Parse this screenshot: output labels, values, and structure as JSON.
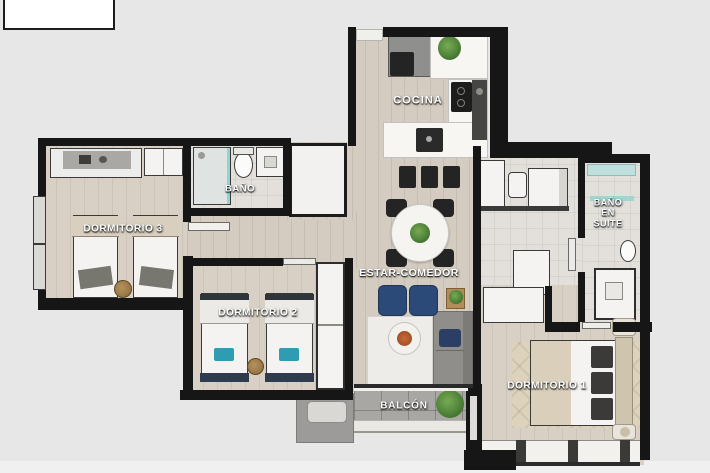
{
  "page": {
    "background_color": "#e7e7e7",
    "bottom_strip_color": "#f0f0f0"
  },
  "title_box": {
    "text": ""
  },
  "floorplan": {
    "type": "apartment-floor-plan-3d-render",
    "rooms": [
      {
        "id": "cocina",
        "label": "COCINA"
      },
      {
        "id": "bano",
        "label": "BAÑO"
      },
      {
        "id": "dormitorio-3",
        "label": "DORMITORIO 3"
      },
      {
        "id": "dormitorio-2",
        "label": "DORMITORIO 2"
      },
      {
        "id": "estar-comedor",
        "label": "ESTAR-COMEDOR"
      },
      {
        "id": "balcon",
        "label": "BALCÓN"
      },
      {
        "id": "dormitorio-1",
        "label": "DORMITORIO 1"
      },
      {
        "id": "bano-en-suite",
        "label_lines": [
          "BAÑO",
          "EN",
          "SUITE"
        ]
      }
    ],
    "palette": {
      "wall": "#161616",
      "wood_floor": "#d4ccc0",
      "bedroom_floor": "#d8d0c4",
      "tile_floor": "#e3e0db",
      "balcony_floor": "#a9a7a3",
      "label_text": "#ffffff",
      "accent_teal": "#2f9cb3",
      "accent_navy": "#2c4a78",
      "plant_green": "#4e8339",
      "sofa_gray": "#8f8e8b",
      "furniture_white": "#f4f3f1"
    }
  }
}
